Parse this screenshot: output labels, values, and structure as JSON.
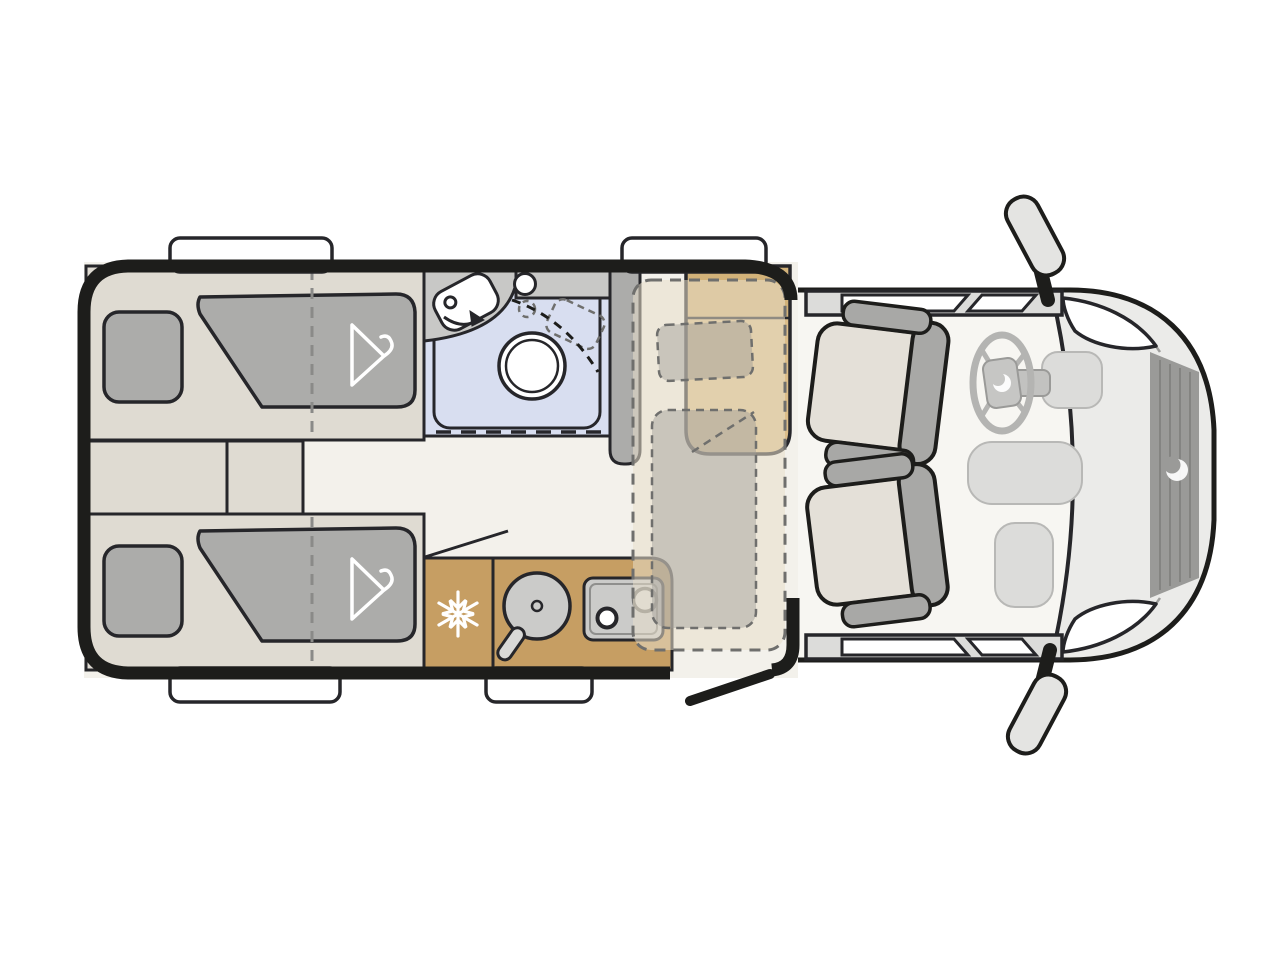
{
  "diagram": {
    "type": "motorhome-floorplan-top-view",
    "orientation": "cab-at-right",
    "areas": {
      "rear_bedroom": {
        "name": "rear-twin-beds",
        "features": [
          "single-bed-upper",
          "single-bed-lower",
          "pillow",
          "duvet-with-hanger-mark",
          "bed-extension-dashed-line",
          "step-cabinets-between-beds"
        ]
      },
      "bathroom": {
        "name": "washroom",
        "features": [
          "swivel-washbasin-with-rotation-arrow",
          "vanity-counter-with-tap",
          "swivel-toilet-with-dashed-positions",
          "shower-tray",
          "shower-door-dashed"
        ]
      },
      "kitchen": {
        "name": "kitchenette",
        "features": [
          "fridge-freezer-snowflake",
          "round-sink-with-faucet",
          "two-burner-hob",
          "door-swing-line"
        ]
      },
      "dinette": {
        "name": "dinette",
        "features": [
          "bench-seat",
          "drop-down-bed-dashed-outline",
          "drop-down-bed-pillow",
          "drop-down-bed-duvet"
        ]
      },
      "cab": {
        "name": "driver-cab",
        "features": [
          "driver-swivel-seat",
          "passenger-swivel-seat",
          "steering-wheel-with-logo",
          "dashboard-consoles",
          "cab-door-windows",
          "wing-mirror-left",
          "wing-mirror-right",
          "headlights",
          "front-grille",
          "brand-logo-swirl"
        ]
      }
    },
    "openings": {
      "windows": [
        "rear-top-window",
        "dinette-top-window",
        "rear-bottom-window",
        "kitchen-bottom-window"
      ],
      "entry_door": "open-door-leaf-bottom-right"
    }
  },
  "colors": {
    "background": "#ffffff",
    "wall": "#1d1d1b",
    "outline": "#26262a",
    "floor_light": "#f3f1eb",
    "furniture_beige": "#dfdbd2",
    "bedding_gray": "#acacaa",
    "bed_divider": "#8a8a88",
    "shower_blue": "#d8def0",
    "counter_gray": "#c8c8c6",
    "wardrobe_gray": "#acacaa",
    "kitchen_tan": "#c69e63",
    "bench_tan": "#dcbe8a",
    "bench_back_tan": "#d2b279",
    "appliance_gray": "#cbcbc9",
    "cab_body": "#ebebe9",
    "cab_floor": "#f7f6f2",
    "cab_gray": "#dcdcda",
    "seat_cushion": "#e4e0d8",
    "seat_gray": "#a8a8a6",
    "wheel_gray": "#b4b4b2",
    "grille_gray": "#9a9a98",
    "mirror_gray": "#e4e4e2",
    "soft_gray": "#9e9e9c",
    "dash_line": "#6f6f6d",
    "white": "#ffffff",
    "overlay_beige": "rgba(231,222,203,0.55)",
    "overlay_gray": "rgba(158,156,150,0.45)"
  }
}
